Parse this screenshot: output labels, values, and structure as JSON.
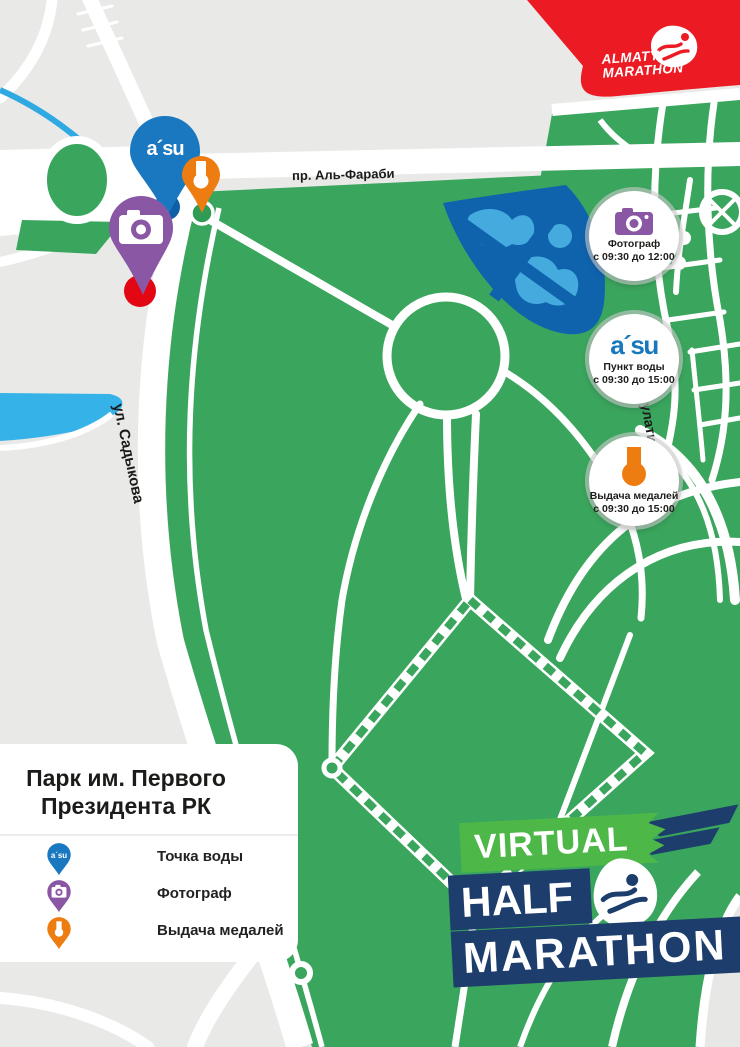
{
  "brand": {
    "almaty_line1": "ALMATY",
    "almaty_line2": "MARATHON",
    "asu": "a´su"
  },
  "event_logo": {
    "virtual": "VIRTUAL",
    "half": "HALF",
    "marathon": "MARATHON"
  },
  "streets": {
    "al_farabi": "пр. Аль-Фараби",
    "sadykova": "ул. Садыкова",
    "dulaty": "ул. Дулати"
  },
  "badges": [
    {
      "icon": "camera-icon",
      "title": "Фотограф",
      "time": "с 09:30 до 12:00"
    },
    {
      "icon": "asu-logo",
      "title": "Пункт воды",
      "time": "с 09:30 до 15:00"
    },
    {
      "icon": "medal-icon",
      "title": "Выдача медалей",
      "time": "с 09:30 до 15:00"
    }
  ],
  "legend": {
    "title_line1": "Парк им. Первого",
    "title_line2": "Президента РК",
    "items": [
      {
        "icon": "asu-pin",
        "label": "Точка воды"
      },
      {
        "icon": "camera-pin",
        "label": "Фотограф"
      },
      {
        "icon": "medal-pin",
        "label": "Выдача медалей"
      }
    ]
  },
  "map_markers": [
    {
      "type": "water-point",
      "icon": "asu-pin"
    },
    {
      "type": "medal-point",
      "icon": "medal-pin"
    },
    {
      "type": "photo-point",
      "icon": "camera-pin"
    },
    {
      "type": "start-dot",
      "icon": "red-dot"
    }
  ],
  "colors": {
    "park_green": "#3aa55d",
    "city_gray": "#e9e9e8",
    "road_white": "#ffffff",
    "water_light_blue": "#35b3e8",
    "pond_dark_blue": "#0f63ad",
    "pond_inner_blue": "#45abdf",
    "asu_blue": "#1a78c0",
    "orange": "#ee7d11",
    "purple": "#8a57a5",
    "marker_red": "#e30613",
    "banner_red": "#ec1b23",
    "navy": "#1d3e6c",
    "logo_green": "#4db848",
    "text_dark": "#1b1b19"
  }
}
